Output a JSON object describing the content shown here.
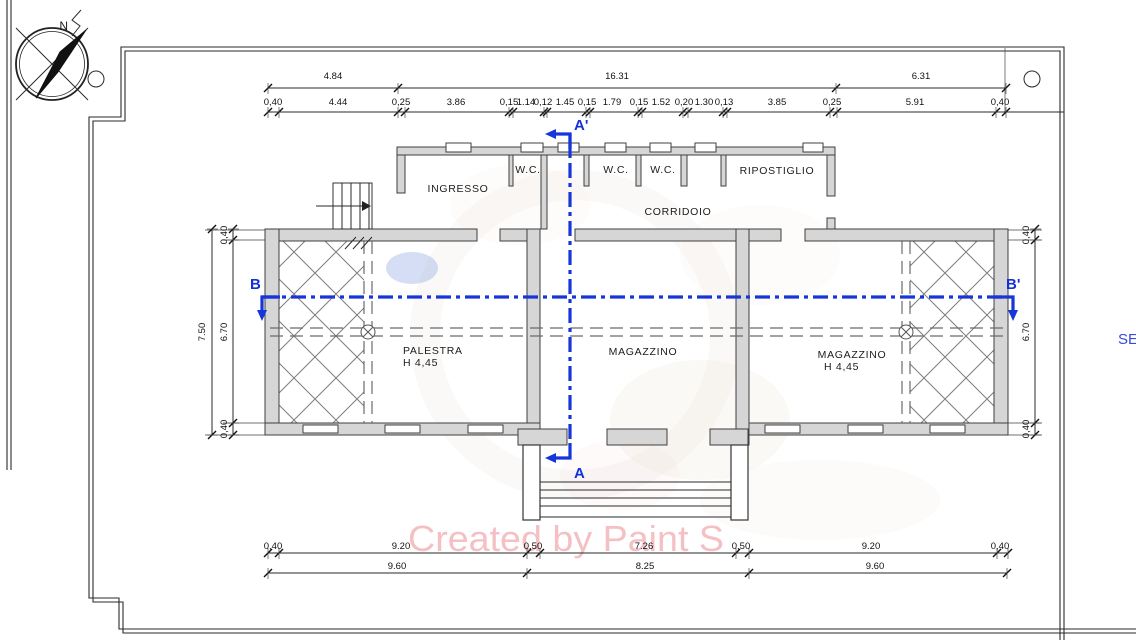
{
  "meta": {
    "type": "architectural-floor-plan",
    "units": "m"
  },
  "compass": {
    "north_label": "N"
  },
  "edge_label": {
    "text": "SE",
    "color": "#3a49d8"
  },
  "watermark": {
    "text": "Created by Paint S",
    "color": "#f4c0c4"
  },
  "colors": {
    "section_blue": "#1636d9",
    "wall_fill": "#d6d6d6",
    "line": "#2a2a2a",
    "hatch": "#7d7d7d"
  },
  "section_markers": [
    {
      "name": "a-top",
      "label": "A'"
    },
    {
      "name": "a-bottom",
      "label": "A"
    },
    {
      "name": "b-left",
      "label": "B"
    },
    {
      "name": "b-right",
      "label": "B'"
    }
  ],
  "rooms": [
    {
      "name": "ingresso",
      "label": "INGRESSO",
      "x": 458,
      "y": 192
    },
    {
      "name": "wc-1",
      "label": "W.C.",
      "x": 528,
      "y": 173
    },
    {
      "name": "wc-2",
      "label": "W.C.",
      "x": 616,
      "y": 173
    },
    {
      "name": "wc-3",
      "label": "W.C.",
      "x": 663,
      "y": 173
    },
    {
      "name": "ripostiglio",
      "label": "RIPOSTIGLIO",
      "x": 777,
      "y": 174
    },
    {
      "name": "corridoio",
      "label": "CORRIDOIO",
      "x": 678,
      "y": 215
    },
    {
      "name": "palestra",
      "label": "PALESTRA",
      "x": 403,
      "y": 354,
      "anchor": "start"
    },
    {
      "name": "palestra-height",
      "label": "H 4,45",
      "x": 403,
      "y": 366,
      "anchor": "start"
    },
    {
      "name": "magazzino-center",
      "label": "MAGAZZINO",
      "x": 643,
      "y": 355
    },
    {
      "name": "magazzino-right",
      "label": "MAGAZZINO",
      "x": 852,
      "y": 358
    },
    {
      "name": "magazzino-right-height",
      "label": "H 4,45",
      "x": 824,
      "y": 370,
      "anchor": "start"
    }
  ],
  "dim_chains_h": [
    {
      "name": "top-overall",
      "y": 88,
      "labelY": 79,
      "divisions": [
        268,
        398,
        836,
        1006
      ],
      "labels": [
        {
          "t": "4.84",
          "x": 333
        },
        {
          "t": "16.31",
          "x": 617
        },
        {
          "t": "6.31",
          "x": 921
        }
      ]
    },
    {
      "name": "top-detail",
      "y": 112,
      "labelY": 105,
      "x2": 1064,
      "divisions": [
        268,
        279,
        398,
        405,
        509,
        513,
        544,
        547,
        586,
        590,
        638,
        642,
        683,
        688,
        723,
        727,
        830,
        837,
        996,
        1006
      ],
      "labels": [
        {
          "t": "0,40",
          "x": 273
        },
        {
          "t": "4.44",
          "x": 338
        },
        {
          "t": "0,25",
          "x": 401
        },
        {
          "t": "3.86",
          "x": 456
        },
        {
          "t": "0,15",
          "x": 509
        },
        {
          "t": "1.14",
          "x": 526
        },
        {
          "t": "0,12",
          "x": 543
        },
        {
          "t": "1.45",
          "x": 565
        },
        {
          "t": "0,15",
          "x": 587
        },
        {
          "t": "1.79",
          "x": 612
        },
        {
          "t": "0,15",
          "x": 639
        },
        {
          "t": "1.52",
          "x": 661
        },
        {
          "t": "0,20",
          "x": 684
        },
        {
          "t": "1.30",
          "x": 704
        },
        {
          "t": "0,13",
          "x": 724
        },
        {
          "t": "3.85",
          "x": 777
        },
        {
          "t": "0,25",
          "x": 832
        },
        {
          "t": "5.91",
          "x": 915
        },
        {
          "t": "0,40",
          "x": 1000
        }
      ]
    },
    {
      "name": "bottom-detail",
      "y": 553,
      "labelY": 549,
      "divisions": [
        268,
        279,
        527,
        540,
        736,
        749,
        997,
        1008
      ],
      "labels": [
        {
          "t": "0,40",
          "x": 273
        },
        {
          "t": "9.20",
          "x": 401
        },
        {
          "t": "0,50",
          "x": 533
        },
        {
          "t": "7.26",
          "x": 644
        },
        {
          "t": "0,50",
          "x": 741
        },
        {
          "t": "9.20",
          "x": 871
        },
        {
          "t": "0,40",
          "x": 1000
        }
      ]
    },
    {
      "name": "bottom-overall",
      "y": 573,
      "labelY": 569,
      "divisions": [
        268,
        527,
        749,
        1007
      ],
      "labels": [
        {
          "t": "9.60",
          "x": 397
        },
        {
          "t": "8.25",
          "x": 645
        },
        {
          "t": "9.60",
          "x": 875
        }
      ]
    }
  ],
  "dim_chains_v": [
    {
      "name": "left-overall",
      "x": 212,
      "labelX": 205,
      "divisions": [
        229,
        435
      ],
      "labels": [
        {
          "t": "7.50",
          "y": 332
        }
      ]
    },
    {
      "name": "left-detail",
      "x": 233,
      "labelX": 227,
      "divisions": [
        229,
        240,
        423,
        435
      ],
      "labels": [
        {
          "t": "0,40",
          "y": 235
        },
        {
          "t": "6.70",
          "y": 332
        },
        {
          "t": "0,40",
          "y": 429
        }
      ]
    },
    {
      "name": "right-detail",
      "x": 1035,
      "labelX": 1029,
      "divisions": [
        229,
        240,
        423,
        435
      ],
      "labels": [
        {
          "t": "0,40",
          "y": 235
        },
        {
          "t": "6.70",
          "y": 332
        },
        {
          "t": "0,40",
          "y": 429
        }
      ]
    }
  ]
}
